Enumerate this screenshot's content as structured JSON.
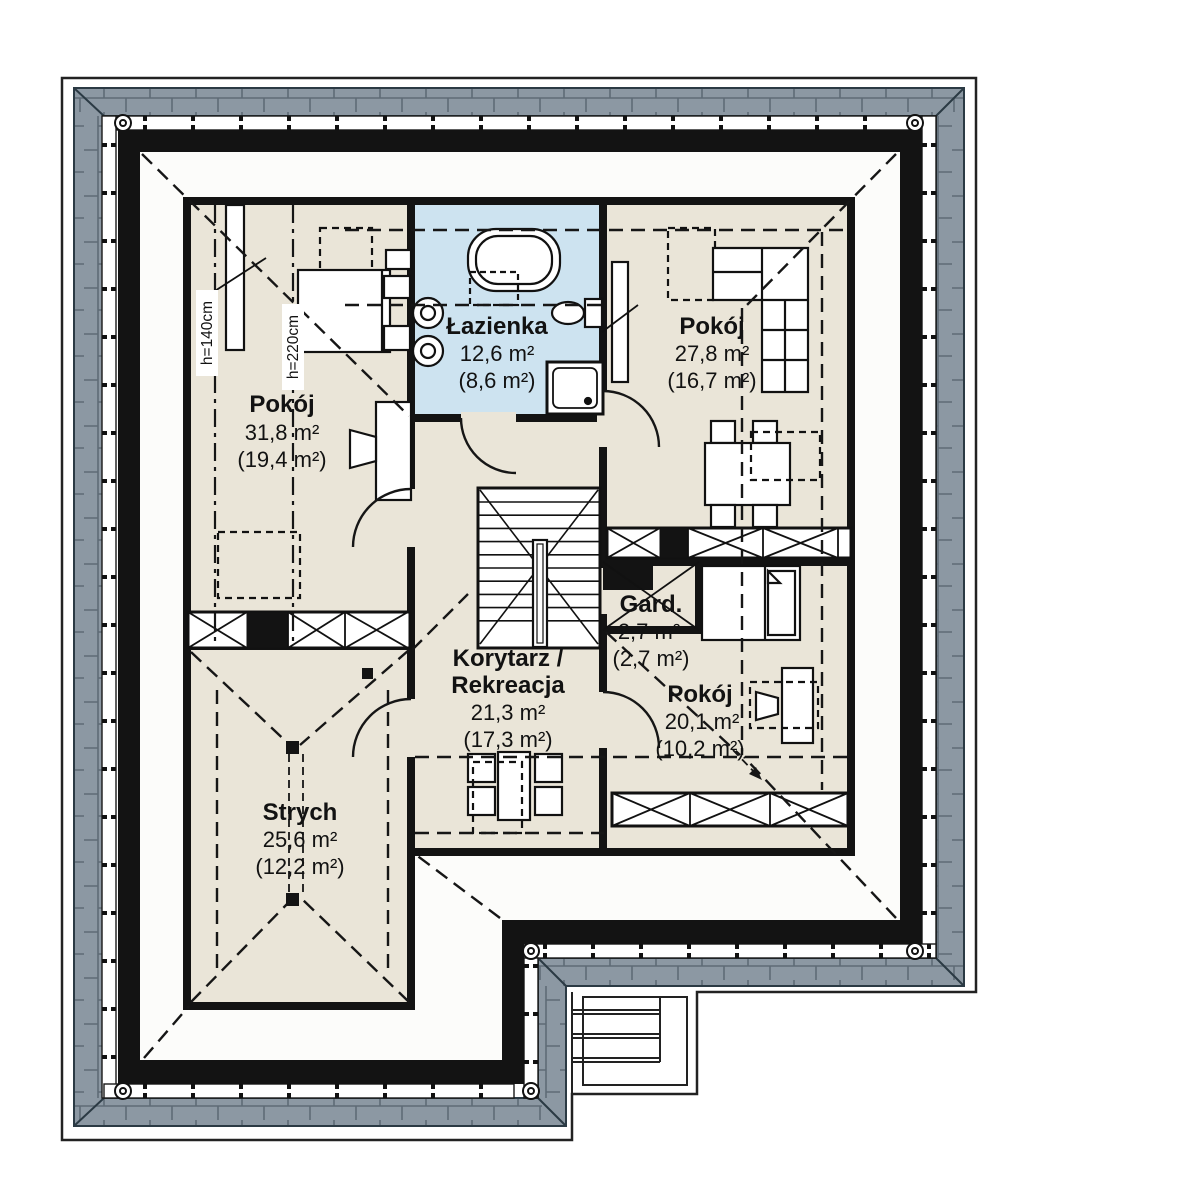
{
  "plan": {
    "type": "floor-plan",
    "floor": "attic storey",
    "rooms": [
      {
        "id": "pokoj-1",
        "name": "Pokój",
        "area": "31,8 m²",
        "area_net": "(19,4 m²)"
      },
      {
        "id": "lazienka",
        "name": "Łazienka",
        "area": "12,6 m²",
        "area_net": "(8,6 m²)"
      },
      {
        "id": "pokoj-2",
        "name": "Pokój",
        "area": "27,8 m²",
        "area_net": "(16,7 m²)"
      },
      {
        "id": "korytarz",
        "name_line1": "Korytarz /",
        "name_line2": "Rekreacja",
        "area": "21,3 m²",
        "area_net": "(17,3 m²)"
      },
      {
        "id": "gard",
        "name": "Gard.",
        "area": "2,7 m²",
        "area_net": "(2,7 m²)"
      },
      {
        "id": "pokoj-3",
        "name": "Pokój",
        "area": "20,1 m²",
        "area_net": "(10,2 m²)"
      },
      {
        "id": "strych",
        "name": "Strych",
        "area": "25,6 m²",
        "area_net": "(12,2 m²)"
      }
    ],
    "annotations": [
      {
        "id": "h140",
        "label": "h=140cm"
      },
      {
        "id": "h220",
        "label": "h=220cm"
      }
    ],
    "colors": {
      "room_fill": "#eae5d8",
      "bath_fill": "#cde3f0",
      "roof_fill": "#8c98a3",
      "roof_line": "#5e6b76",
      "wall": "#131313",
      "floor": "#fcfcfa",
      "outline": "#222222"
    }
  }
}
